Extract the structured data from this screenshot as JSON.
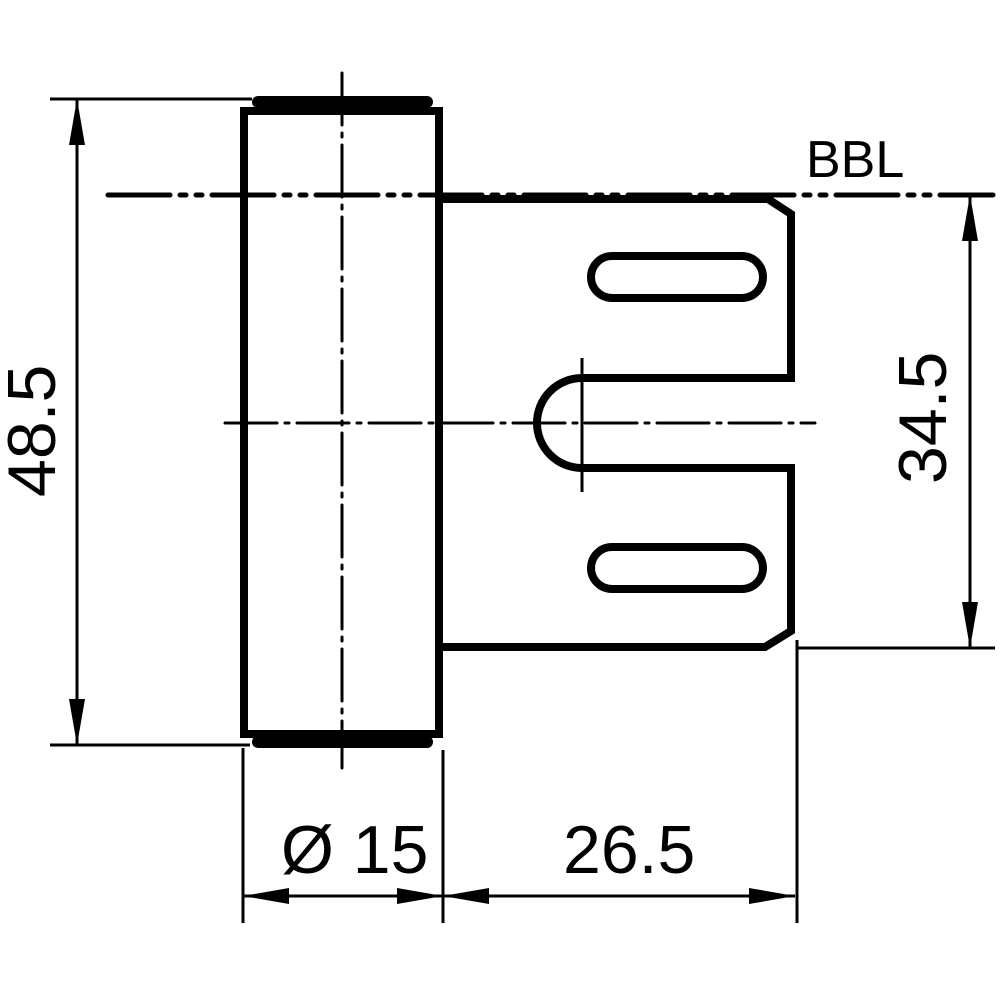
{
  "drawing": {
    "type": "technical-drawing",
    "view": "hinge frame part side view",
    "colors": {
      "line": "#000000",
      "background": "#ffffff"
    },
    "labels": {
      "bbl": "BBL",
      "overall_height": "48.5",
      "plate_height": "34.5",
      "barrel_diameter": "Ø 15",
      "plate_depth": "26.5"
    },
    "dimensions": [
      {
        "name": "overall-height",
        "value": "48.5",
        "axis": "vertical",
        "side": "left"
      },
      {
        "name": "plate-height",
        "value": "34.5",
        "axis": "vertical",
        "side": "right"
      },
      {
        "name": "barrel-diameter",
        "value": "Ø 15",
        "axis": "horizontal",
        "side": "bottom"
      },
      {
        "name": "plate-depth",
        "value": "26.5",
        "axis": "horizontal",
        "side": "bottom"
      }
    ]
  }
}
